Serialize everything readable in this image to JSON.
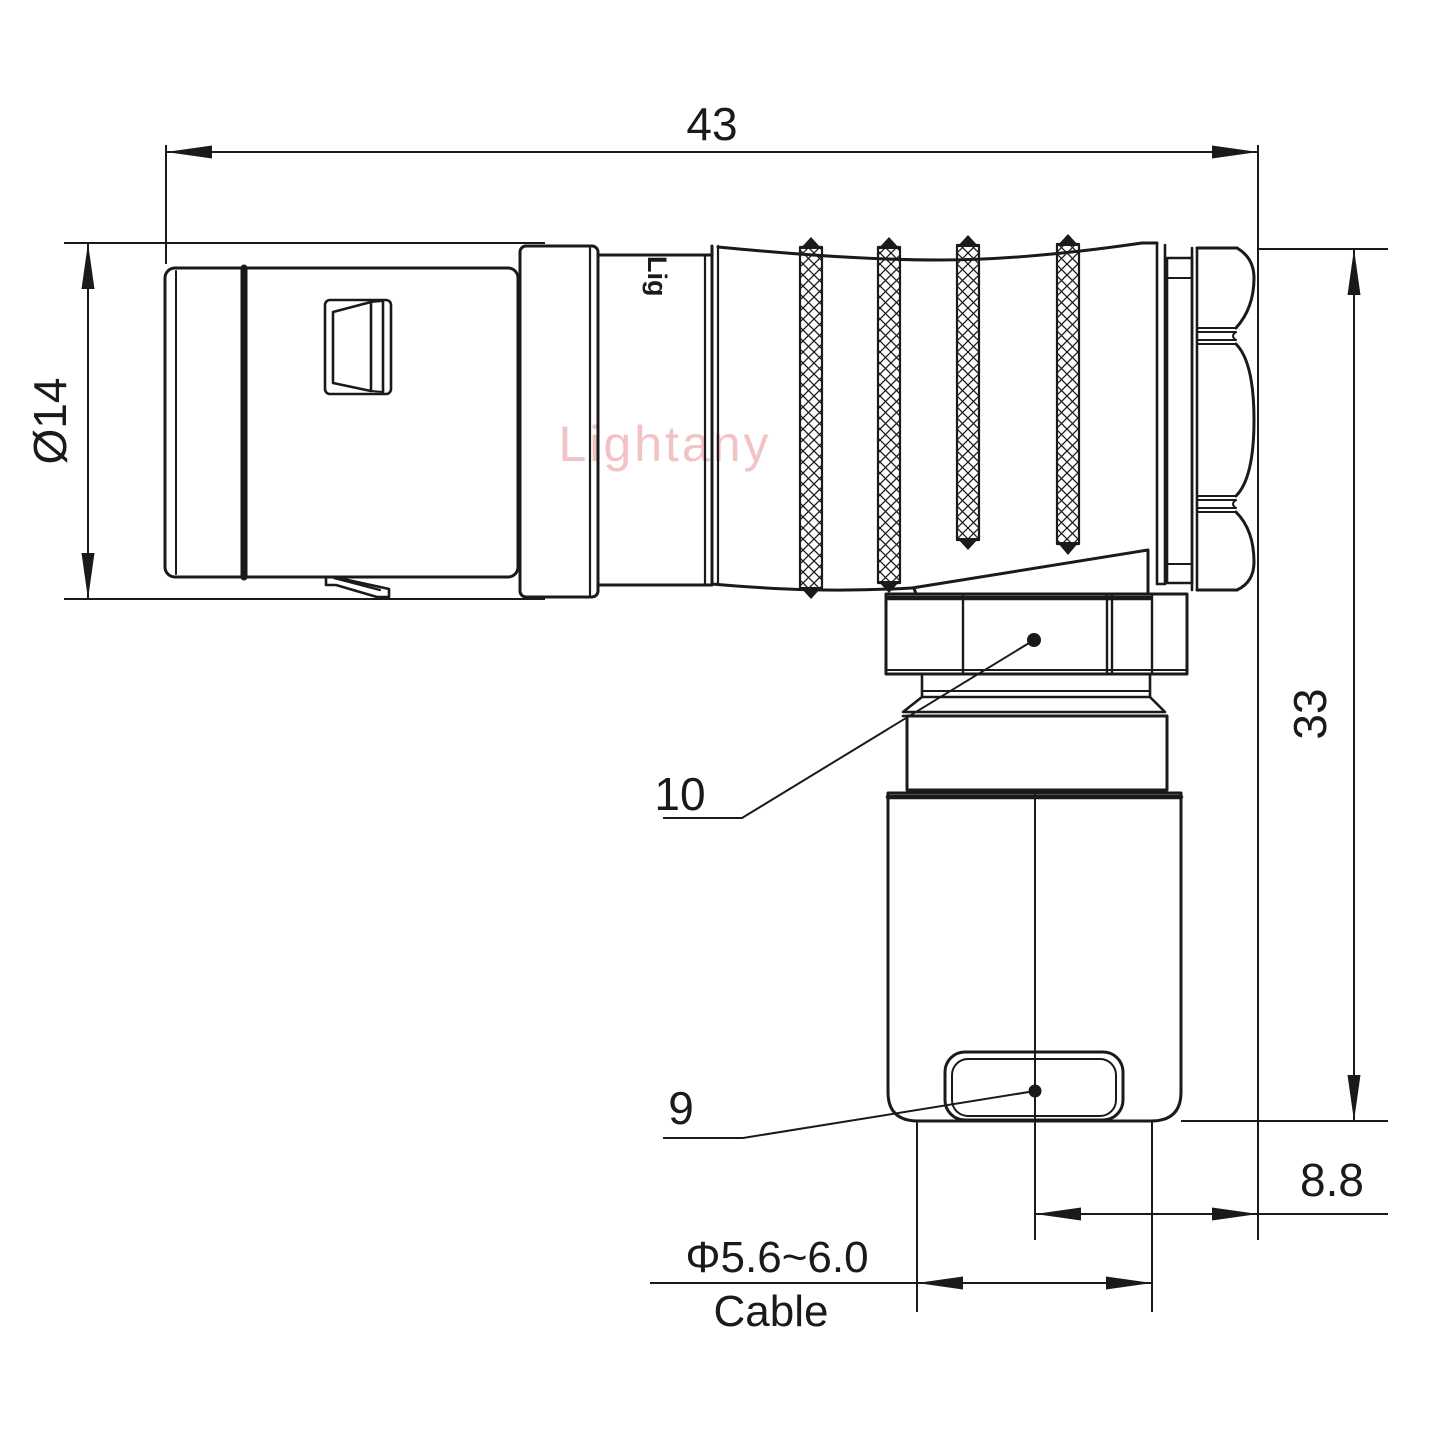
{
  "drawing": {
    "watermark": "Lightany",
    "part_marking": "Lig",
    "labels": {
      "overall_length": "43",
      "diameter": "Ø14",
      "height": "33",
      "offset": "8.8",
      "cable_diameter": "Φ5.6~6.0",
      "cable": "Cable",
      "callout_coupling_nut": "10",
      "callout_cable_clamp": "9"
    },
    "colors": {
      "line": "#1a1a1a",
      "background": "#ffffff",
      "watermark": "#f2c3c3"
    }
  }
}
